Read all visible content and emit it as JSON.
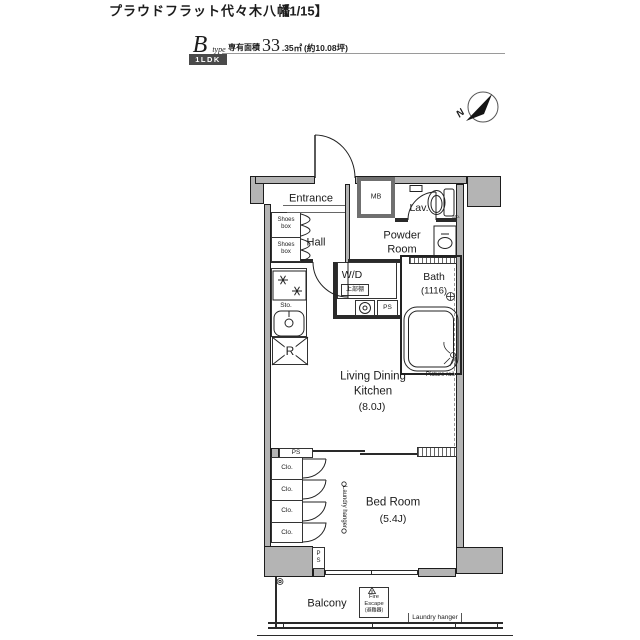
{
  "header": {
    "title": "プラウドフラット代々木八幡",
    "page": "【1/15】",
    "type_letter": "B",
    "type_sub": "type",
    "badge": "1LDK",
    "area_label": "専有面積",
    "area_big": "33",
    "area_small": ".35㎡",
    "area_paren": "(約10.08坪)"
  },
  "compass": {
    "n": "N"
  },
  "labels": {
    "entrance": "Entrance",
    "mb": "MB",
    "lav": "Lav.",
    "hall": "Hall",
    "powder_l1": "Powder",
    "powder_l2": "Room",
    "wd": "W/D",
    "wd_shelf": "上部棚",
    "ps_top": "PS",
    "ps_mid": "PS",
    "ps_bottom": "PS",
    "bath_l1": "Bath",
    "bath_l2": "(1116)",
    "ldk_l1": "Living Dining",
    "ldk_l2": "Kitchen",
    "ldk_size": "(8.0J)",
    "picture_rail": "Picture rail",
    "bed_l1": "Bed Room",
    "bed_size": "(5.4J)",
    "balcony": "Balcony",
    "fire_l1": "Fire",
    "fire_l2": "Escape",
    "fire_l3": "(避難器)",
    "laundry_hanger_balcony": "Laundry hanger",
    "laundry_hanger_room": "Laundry hanger",
    "sto_kitchen": "Sto.",
    "sto_lav": "Sto.",
    "refrigerator": "R",
    "shoes": [
      "Shoes box",
      "Shoes box"
    ],
    "closets": [
      "Clo.",
      "Clo.",
      "Clo.",
      "Clo."
    ]
  }
}
